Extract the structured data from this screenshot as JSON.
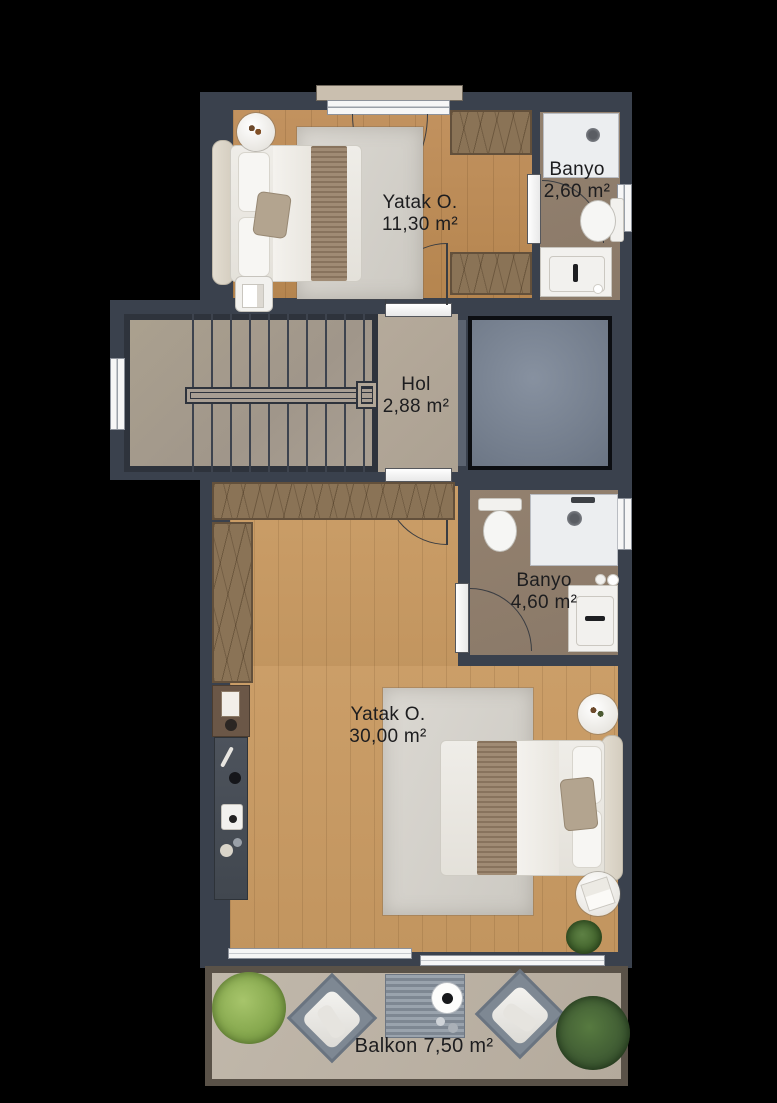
{
  "plan": {
    "type": "floor-plan",
    "rooms": {
      "bedroom1": {
        "name": "Yatak O.",
        "area": "11,30 m²"
      },
      "bathroom1": {
        "name": "Banyo",
        "area": "2,60 m²"
      },
      "hall": {
        "name": "Hol",
        "area": "2,88 m²"
      },
      "bathroom2": {
        "name": "Banyo",
        "area": "4,60 m²"
      },
      "bedroom2": {
        "name": "Yatak O.",
        "area": "30,00 m²"
      },
      "balcony": {
        "label": "Balkon 7,50 m²"
      }
    },
    "colors": {
      "background": "#000000",
      "wall": "#3a414d",
      "wood_floor_1": "#b8885a",
      "wood_floor_2": "#c2955f",
      "stair_floor": "#a69c90",
      "hall_floor": "#b1a698",
      "bath_floor": "#8d7b6d",
      "balcony_floor": "#bcb3a6",
      "rug": "#d6d3cd",
      "wardrobe": "#8a7356",
      "shaft": "#77808e",
      "fixture_white": "#eceef0",
      "label_text": "#1d1d1f"
    }
  }
}
